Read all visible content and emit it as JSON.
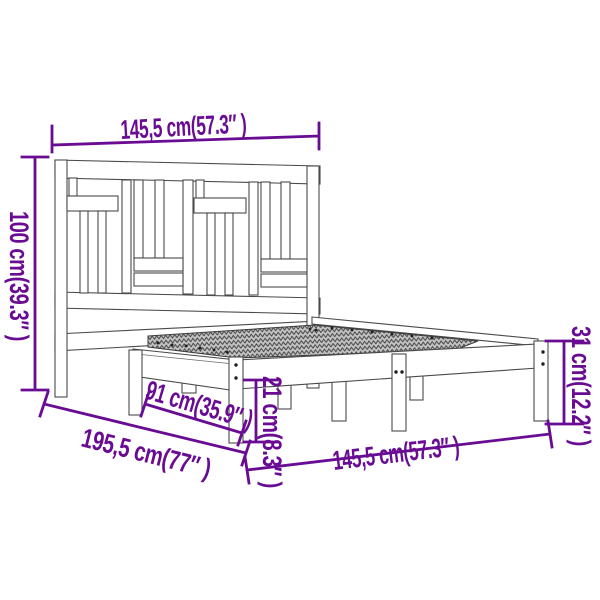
{
  "diagram": {
    "title": "bed-frame-with-headboard-dimension-diagram",
    "accent_color": "#690c93",
    "figure_line_color": "#4a4a4a",
    "background_color": "#ffffff",
    "labels": {
      "headboard_width": "145,5 cm(57.3″ )",
      "headboard_height": "100 cm(39.3″ )",
      "frame_height": "31 cm(12.2″ )",
      "rail_height": "21 cm(8.3″ )",
      "inner_length": "91 cm(35.9″ )",
      "frame_length": "195,5 cm(77″ )",
      "frame_width": "145,5 cm(57.3″ )"
    }
  }
}
